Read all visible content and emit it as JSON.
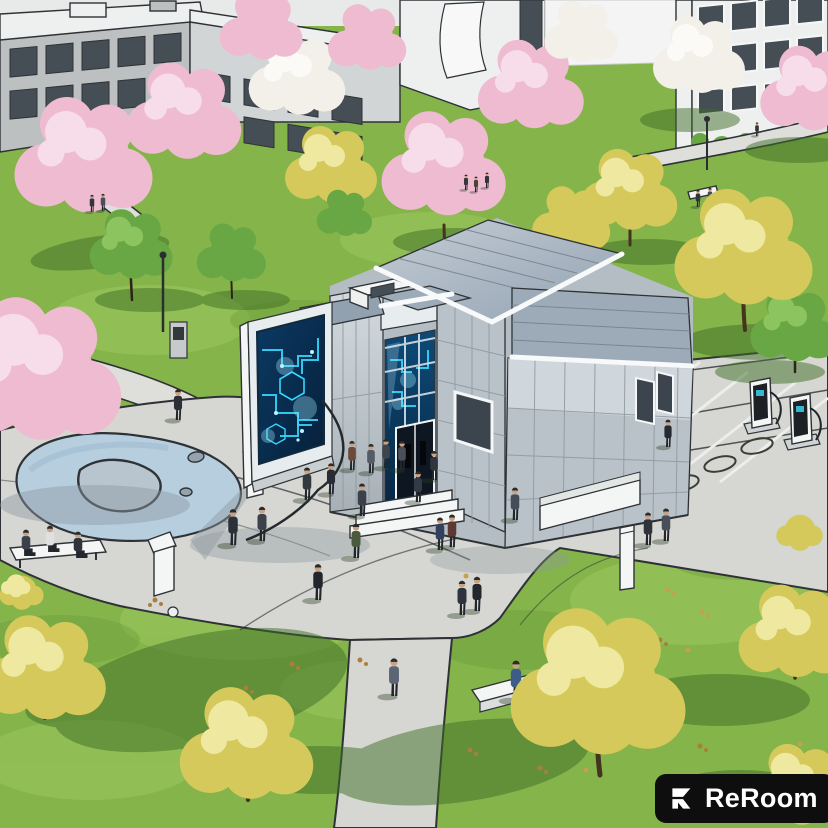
{
  "watermark": {
    "brand": "ReRoom",
    "icon": "reroom-logo-icon"
  },
  "scene": {
    "alt": "Aerial architectural illustration of a campus plaza: a futuristic metal-clad pavilion with glowing blue digital screens, a freestanding media wall, a pond, EV charging stations with marked stalls, winding gray paths, blossoming pink and yellow trees, and many pedestrians on green lawns with sketched campus buildings behind."
  },
  "colors": {
    "outline": "#2e3236",
    "grass": "#84b44a",
    "grassHi": "#9dc95f",
    "grassLo": "#6b9a3a",
    "shadowGreen": "#3e6d27",
    "plaza": "#d6d7d2",
    "path": "#dedfda",
    "pond": "#b7cede",
    "pondDeep": "#9fbccf",
    "island": "#b9c5ce",
    "white": "#f4f6f5",
    "fascia": "#f7f9fa",
    "roof": "#9dabb9",
    "roofHi": "#c3ccd5",
    "roofSeam": "#76828e",
    "silver": "#b9c2c9",
    "silverHi": "#e7ecef",
    "panelLeft": "#cdd5d9",
    "panelSeam": "#8d979e",
    "windowDark": "#454e55",
    "screenDeep": "#082743",
    "screenMid": "#0d4a78",
    "circuit": "#35d8ff",
    "glow": "#9feaff",
    "bgGray": "#bcc0c1",
    "bgGrayHi": "#d2d5d5",
    "bgWhite": "#eef0ef",
    "trunk": "#45321f",
    "pink": "#eebbd0",
    "pinkHi": "#f7dde9",
    "blossom": "#f3f0ea",
    "blossomHi": "#fbfaf6",
    "yellow": "#d5c95c",
    "yellowHi": "#efe8a0",
    "treeGreen": "#68a743",
    "treeGreenHi": "#8cc45f",
    "concreteShadow": "#8f99a1",
    "skin": "#c9a184",
    "badgeBg": "#0e0e0e",
    "badgeFg": "#ffffff"
  }
}
